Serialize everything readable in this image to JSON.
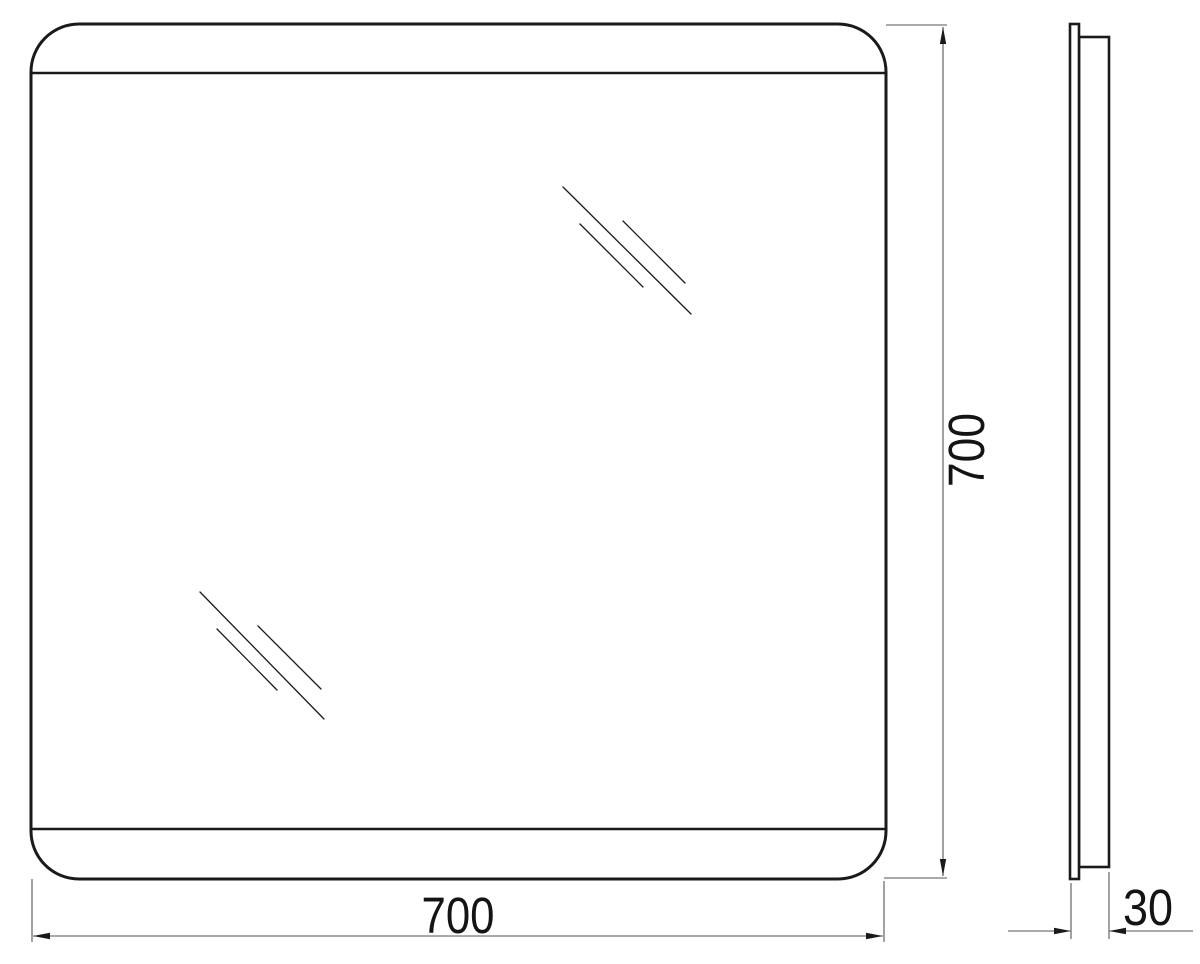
{
  "document": {
    "type": "technical-dimension-drawing",
    "subject": "mirror-front-and-side-elevation",
    "background_color": "#ffffff",
    "object_line_color": "#1a1a1a",
    "dimension_line_color": "#555555",
    "text_color": "#141414"
  },
  "dimensions": {
    "width": {
      "label": "700"
    },
    "height": {
      "label": "700"
    },
    "depth": {
      "label": "30"
    }
  },
  "geometry": {
    "canvas": {
      "width": 1200,
      "height": 964
    },
    "front_view": {
      "outline": {
        "x": 31,
        "y": 24,
        "width": 855,
        "height": 855,
        "corner_radius": 48,
        "stroke_width": 3
      },
      "band_stroke_width": 2.4,
      "band_lines": [
        [
          31,
          73,
          886,
          73
        ],
        [
          31,
          829,
          886,
          829
        ]
      ],
      "reflection_stroke_width": 1.3,
      "reflection_marks": [
        [
          563,
          187,
          691,
          314
        ],
        [
          580,
          224,
          643,
          287
        ],
        [
          623,
          221,
          685,
          283
        ],
        [
          200,
          592,
          324,
          719
        ],
        [
          217,
          629,
          277,
          690
        ],
        [
          258,
          626,
          321,
          689
        ]
      ]
    },
    "side_view": {
      "stroke_width": 2.6,
      "glass_panel": {
        "x": 1070,
        "y": 24,
        "width": 9,
        "height": 855
      },
      "body_panel": {
        "x": 1079,
        "y": 37,
        "width": 30,
        "height": 830
      }
    },
    "dims": {
      "width": {
        "extension_lines": [
          [
            32,
            879,
            32,
            942
          ],
          [
            884,
            881,
            884,
            942
          ]
        ],
        "lines": [
          [
            33,
            936,
            883,
            936
          ]
        ],
        "arrows": [
          [
            33,
            936,
            "left"
          ],
          [
            883,
            936,
            "right"
          ]
        ],
        "label_pos": {
          "x": 458,
          "y": 933,
          "rotate": 0
        }
      },
      "height": {
        "extension_lines": [
          [
            886,
            25,
            947,
            25
          ],
          [
            884,
            878,
            947,
            878
          ]
        ],
        "lines": [
          [
            943,
            27,
            943,
            876
          ]
        ],
        "arrows": [
          [
            943,
            27,
            "up"
          ],
          [
            943,
            876,
            "down"
          ]
        ],
        "label_pos": {
          "x": 984,
          "y": 450,
          "rotate": -90
        }
      },
      "depth": {
        "extension_lines": [
          [
            1071,
            883,
            1071,
            939
          ],
          [
            1109,
            872,
            1109,
            939
          ]
        ],
        "lines": [
          [
            1008,
            931,
            1070,
            931
          ],
          [
            1110,
            931,
            1193,
            931
          ]
        ],
        "arrows": [
          [
            1071,
            931,
            "right"
          ],
          [
            1109,
            931,
            "left"
          ]
        ],
        "label_pos": {
          "x": 1148,
          "y": 925,
          "rotate": 0
        }
      }
    },
    "arrow_style": {
      "length": 17,
      "half_width": 3.2
    },
    "label_style": {
      "font_size": 51,
      "text_lengths": {
        "width": 73,
        "height": 74,
        "depth": 50
      }
    }
  }
}
